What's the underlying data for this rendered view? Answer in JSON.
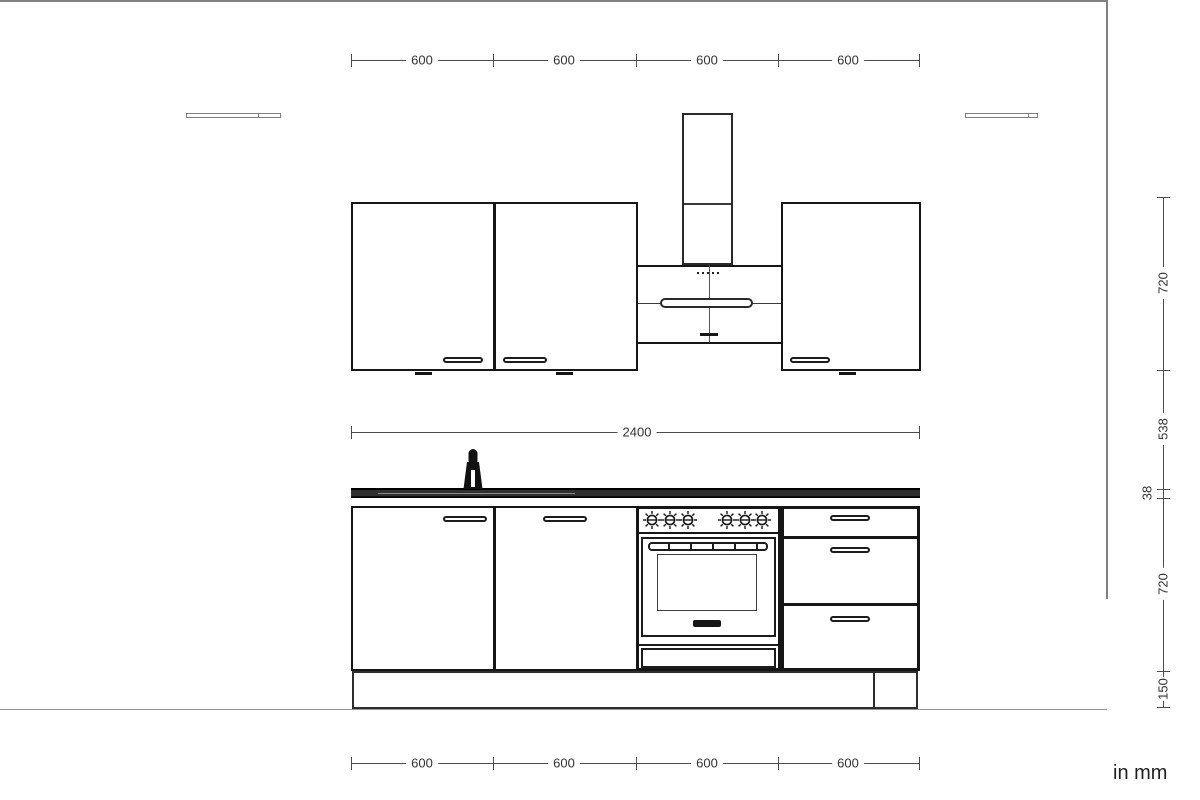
{
  "dims": {
    "top": [
      "600",
      "600",
      "600",
      "600"
    ],
    "middle": "2400",
    "bottom": [
      "600",
      "600",
      "600",
      "600"
    ],
    "right": [
      "720",
      "538",
      "38",
      "720",
      "150"
    ],
    "unit": "in mm"
  },
  "colors": {
    "cabinet_line": "#161616",
    "wall_line": "#7f7f7f",
    "dimension_line": "#4b4b4b",
    "countertop_fill": "#2f2f2f"
  },
  "icons": {
    "faucet": "faucet-silhouette",
    "oven_knob": "dial-with-spokes",
    "hood_controls": "five-dots"
  }
}
